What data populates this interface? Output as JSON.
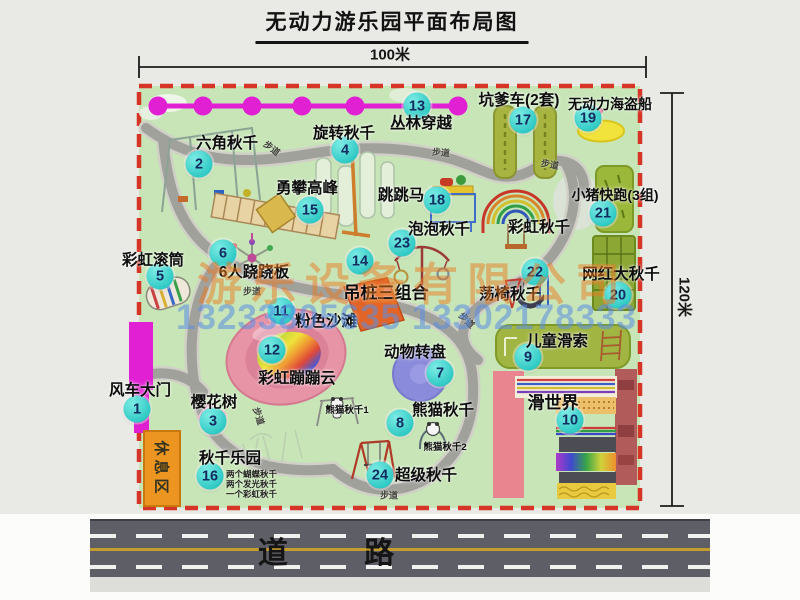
{
  "title": "无动力游乐园平面布局图",
  "dim_width": "100米",
  "dim_height": "120米",
  "road_label": "道 路",
  "rest_area": "休息区",
  "path_label": "步道",
  "rainbow_swing_label": "彩虹秋千",
  "watermark": {
    "company": "游乐设备有限公司",
    "phones": "13233805635 13302178333"
  },
  "attractions": [
    {
      "num": "1",
      "label": "风车大门"
    },
    {
      "num": "2",
      "label": "六角秋千"
    },
    {
      "num": "3",
      "label": "樱花树"
    },
    {
      "num": "4",
      "label": "旋转秋千"
    },
    {
      "num": "5",
      "label": "彩虹滚筒"
    },
    {
      "num": "6",
      "label": "6人跷跷板"
    },
    {
      "num": "7",
      "label": "动物转盘"
    },
    {
      "num": "8",
      "label": "熊猫秋千"
    },
    {
      "num": "9",
      "label": "儿童滑索"
    },
    {
      "num": "10",
      "label": "滑世界"
    },
    {
      "num": "11",
      "label": "粉色沙滩"
    },
    {
      "num": "12",
      "label": "彩虹蹦蹦云"
    },
    {
      "num": "13",
      "label": "丛林穿越"
    },
    {
      "num": "14",
      "label": "吊桩三组合"
    },
    {
      "num": "15",
      "label": "勇攀高峰"
    },
    {
      "num": "16",
      "label": "秋千乐园"
    },
    {
      "num": "17",
      "label": "坑爹车(2套)"
    },
    {
      "num": "18",
      "label": "跳跳马"
    },
    {
      "num": "19",
      "label": "无动力海盗船"
    },
    {
      "num": "20",
      "label": "网红大秋千"
    },
    {
      "num": "21",
      "label": "小猪快跑(3组)"
    },
    {
      "num": "22",
      "label": "荡椅秋千"
    },
    {
      "num": "23",
      "label": "泡泡秋千"
    },
    {
      "num": "24",
      "label": "超级秋千"
    }
  ],
  "sub_labels": {
    "panda1": "熊猫秋千1",
    "panda2": "熊猫秋千2",
    "swing_notes": [
      "两个蝴蝶秋千",
      "两个发光秋千",
      "一个彩虹秋千"
    ]
  }
}
